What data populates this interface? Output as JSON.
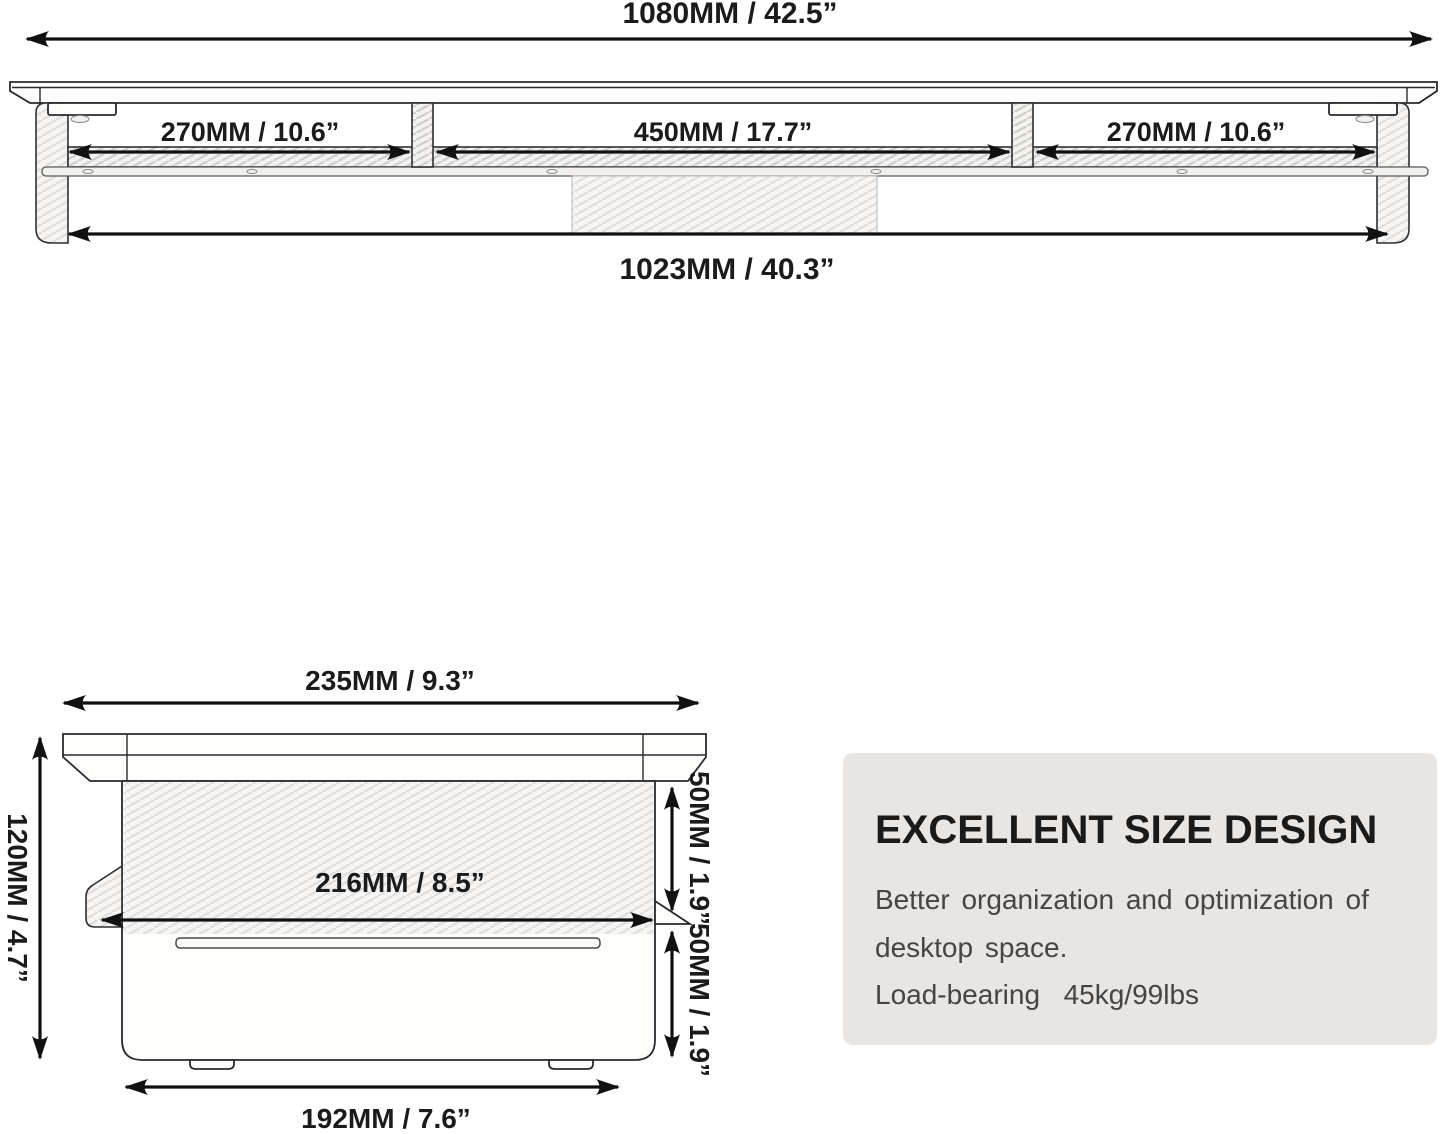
{
  "front_view": {
    "label_total_width": "1080MM / 42.5”",
    "label_left_section": "270MM / 10.6”",
    "label_middle_section": "450MM / 17.7”",
    "label_right_section": "270MM / 10.6”",
    "label_inner_width": "1023MM / 40.3”"
  },
  "side_view": {
    "label_top_width": "235MM / 9.3”",
    "label_height": "120MM / 4.7”",
    "label_inner_width": "216MM / 8.5”",
    "label_upper_clearance": "50MM / 1.9”",
    "label_lower_clearance": "50MM / 1.9”",
    "label_base_width": "192MM / 7.6”"
  },
  "info_box": {
    "title": "EXCELLENT SIZE DESIGN",
    "body_line1": "Better organization and optimization of",
    "body_line2": "desktop space.",
    "body_line3": "Load-bearing  45kg/99lbs",
    "background_color": "#e8e5e2",
    "title_color": "#1a1a1a",
    "body_color": "#454545"
  },
  "colors": {
    "line": "#111111",
    "background": "#ffffff"
  }
}
